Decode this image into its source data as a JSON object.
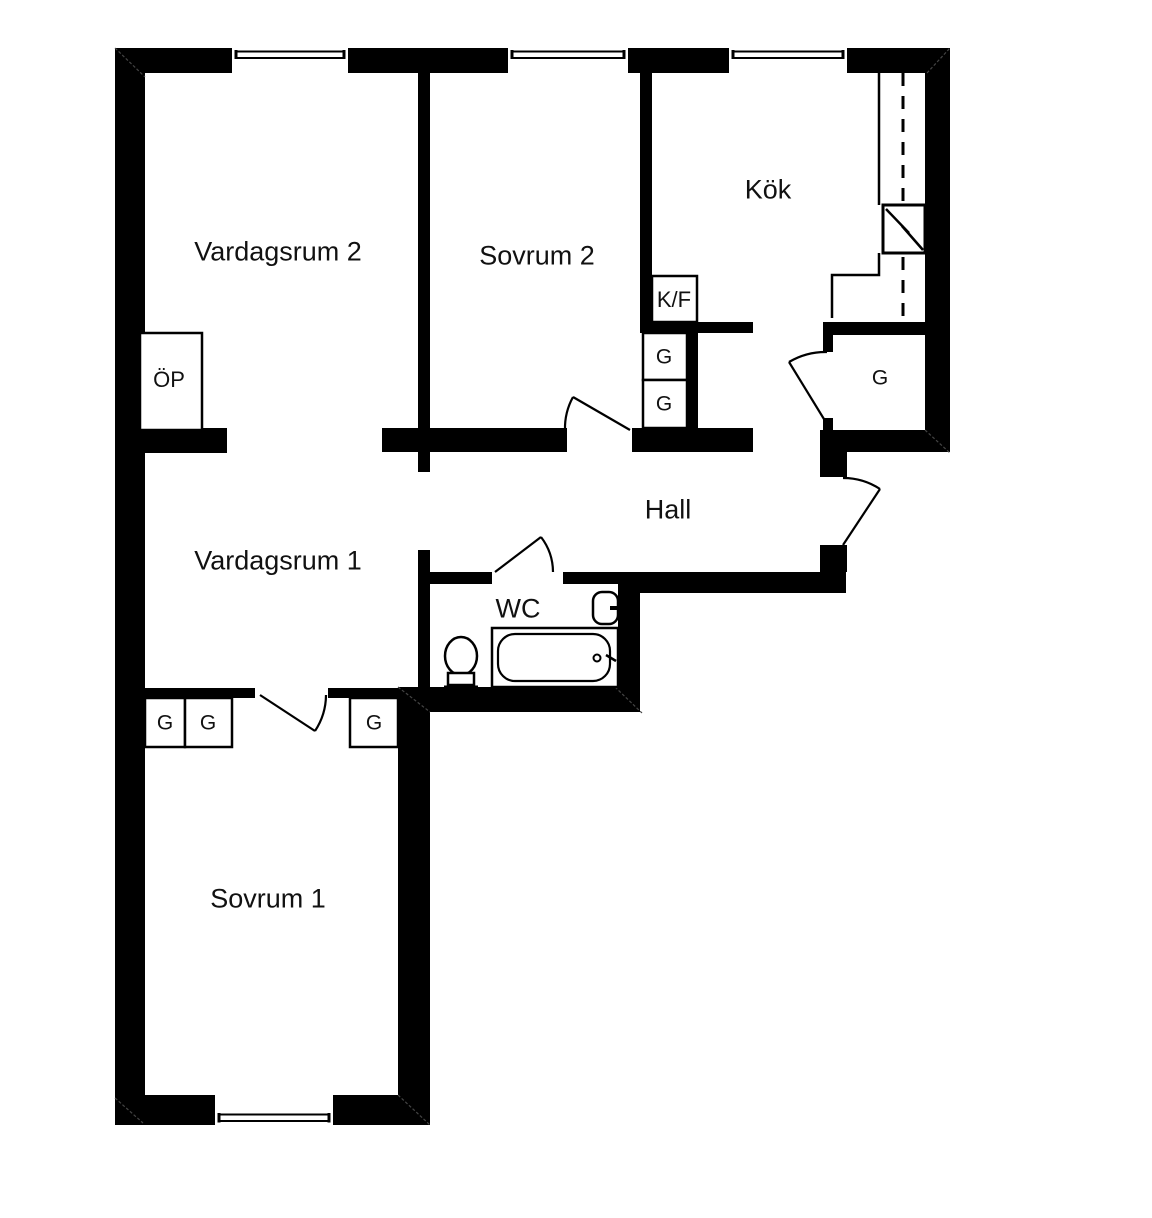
{
  "plan": {
    "type": "apartment-floorplan",
    "rooms": {
      "vardagsrum2": "Vardagsrum 2",
      "sovrum2": "Sovrum 2",
      "kok": "Kök",
      "hall": "Hall",
      "vardagsrum1": "Vardagsrum 1",
      "wc": "WC",
      "sovrum1": "Sovrum 1"
    },
    "fixtures": {
      "fireplace_label": "ÖP",
      "fridge_freezer_label": "K/F",
      "wardrobe_label": "G"
    },
    "symbols": [
      "window-symbol",
      "door-arc",
      "bathtub-symbol",
      "toilet-symbol",
      "washbasin-symbol",
      "kitchen-sink-symbol",
      "kitchen-counter",
      "overhead-cabinet-dashed-line",
      "corner-chamfer-line"
    ],
    "colors": {
      "wall": "#000000",
      "floor": "#ffffff",
      "line": "#000000",
      "chamfer": "#444444",
      "text": "#111111"
    }
  }
}
